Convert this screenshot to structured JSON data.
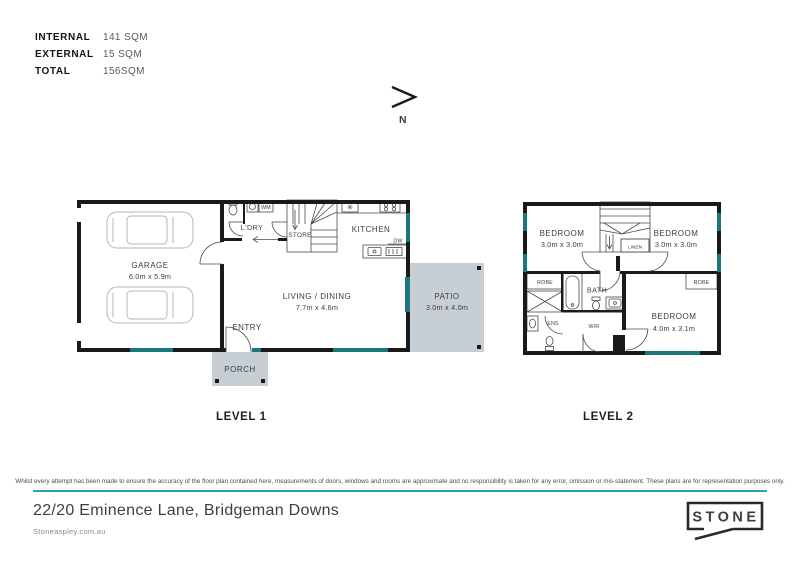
{
  "areas": {
    "rows": [
      {
        "label": "INTERNAL",
        "value": "141 SQM"
      },
      {
        "label": "EXTERNAL",
        "value": "15 SQM"
      },
      {
        "label": "TOTAL",
        "value": "156SQM"
      }
    ]
  },
  "compass": {
    "label": "N"
  },
  "level1": {
    "title": "LEVEL 1",
    "garage": {
      "name": "GARAGE",
      "dims": "6.0m x 5.9m"
    },
    "laundry": "L'DRY",
    "wm": "WM",
    "store": "STORE",
    "kitchen": "KITCHEN",
    "dw": "DW",
    "living": {
      "name": "LIVING / DINING",
      "dims": "7.7m x 4.6m"
    },
    "entry": "ENTRY",
    "porch": "PORCH",
    "patio": {
      "name": "PATIO",
      "dims": "3.0m x 4.0m"
    }
  },
  "level2": {
    "title": "LEVEL 2",
    "bedroom_left": {
      "name": "BEDROOM",
      "dims": "3.0m x 3.0m"
    },
    "bedroom_right": {
      "name": "BEDROOM",
      "dims": "3.0m x 3.0m"
    },
    "bedroom_main": {
      "name": "BEDROOM",
      "dims": "4.0m x 3.1m"
    },
    "linen": "LINEN",
    "robe_left": "ROBE",
    "robe_right": "ROBE",
    "bath": "BATH",
    "ens": "ENS",
    "wir": "WIR"
  },
  "disclaimer": "Whilst every attempt has been made to ensure the accuracy of the floor plan contained here, measurements of doors, windows and rooms are approximate and no responsibility is taken for any error, omission or mis-statement. These plans are for representation purposes only.",
  "footer": {
    "address": "22/20 Eminence Lane, Bridgeman Downs",
    "website": "Stoneaspley.com.au",
    "logo": "STONE"
  },
  "colors": {
    "wall": "#1a1a1a",
    "window_teal": "#1b767d",
    "outdoor_fill": "#c7cfd4",
    "divider_teal": "#2aa2b3"
  }
}
